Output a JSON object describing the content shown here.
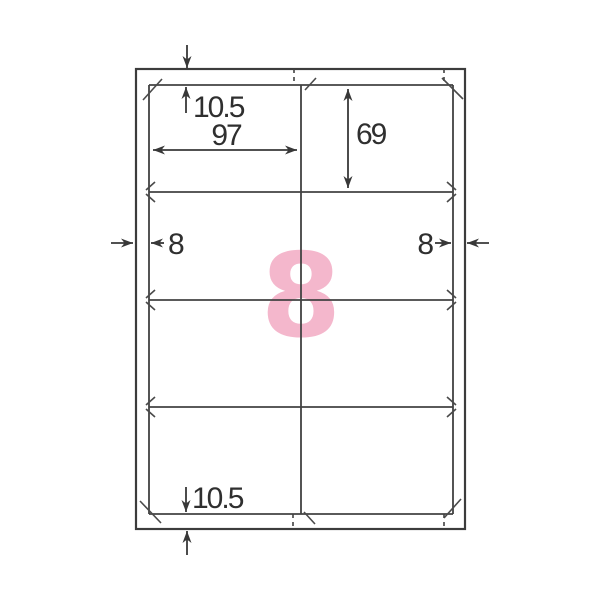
{
  "diagram": {
    "type": "label-sheet-template",
    "labels_per_sheet": "8",
    "grid": {
      "columns": 2,
      "rows": 4
    },
    "dimensions_mm": {
      "top_margin": "10.5",
      "label_width": "97",
      "label_height": "69",
      "left_margin": "8",
      "right_margin": "8",
      "bottom_margin": "10.5"
    },
    "colors": {
      "line": "#424242",
      "count_pink": "#f3abc4",
      "background": "#ffffff"
    }
  }
}
